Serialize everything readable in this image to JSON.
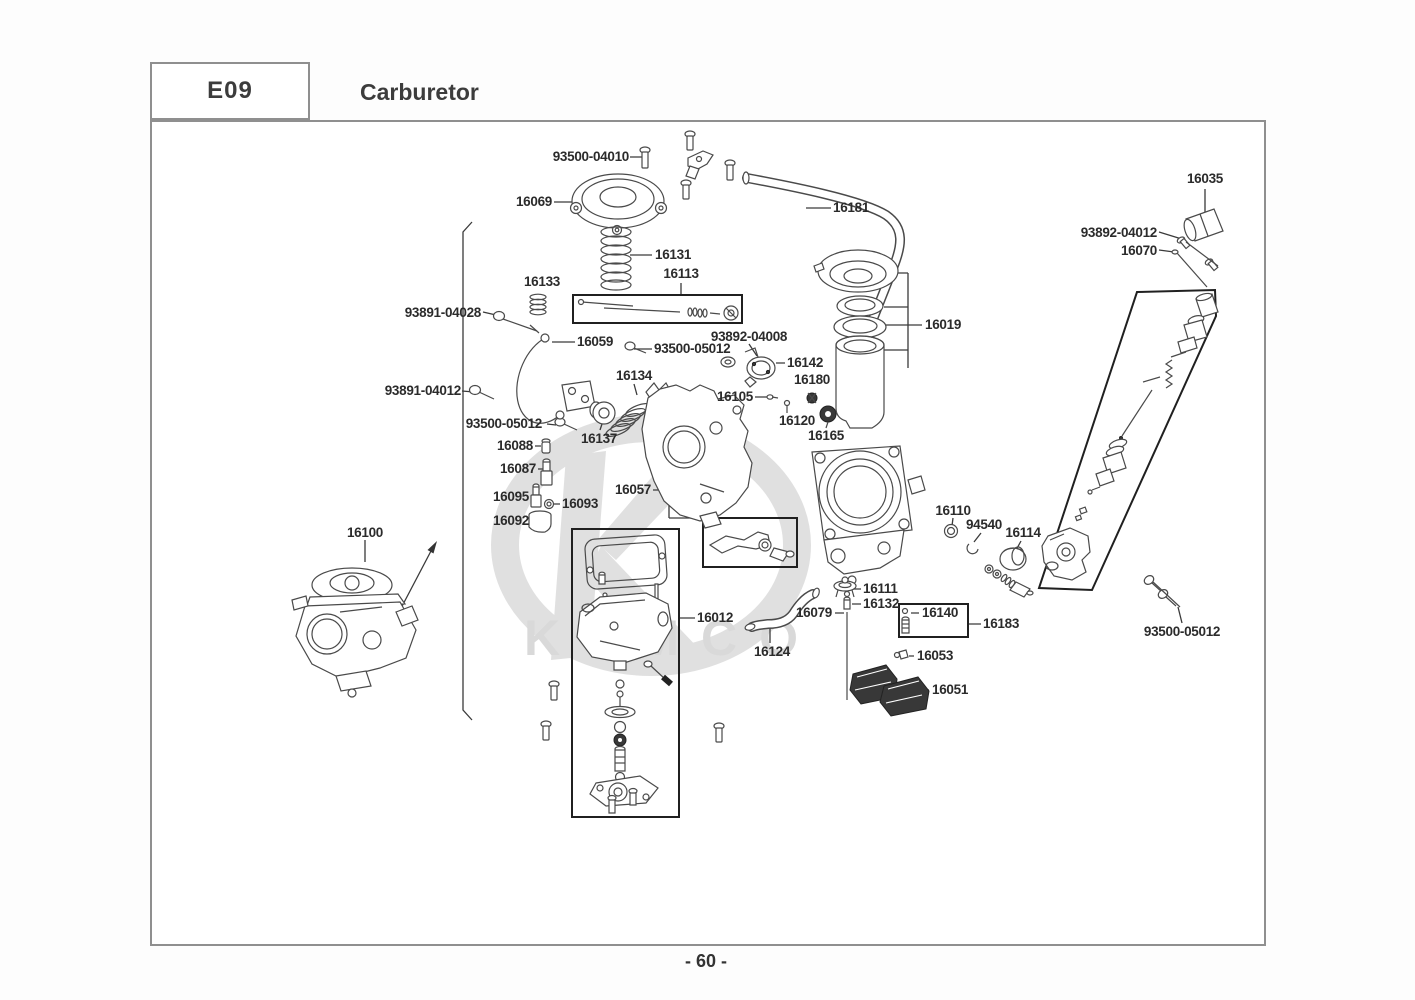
{
  "header": {
    "code": "E09",
    "title": "Carburetor"
  },
  "footer": {
    "page_number": "- 60 -"
  },
  "watermark": {
    "brand": "KYMCO"
  },
  "part_labels": [
    {
      "id": "93500-04010",
      "text": "93500-04010"
    },
    {
      "id": "16069",
      "text": "16069"
    },
    {
      "id": "16181",
      "text": "16181"
    },
    {
      "id": "16035",
      "text": "16035"
    },
    {
      "id": "93892-04012",
      "text": "93892-04012"
    },
    {
      "id": "16070",
      "text": "16070"
    },
    {
      "id": "16131",
      "text": "16131"
    },
    {
      "id": "16113",
      "text": "16113"
    },
    {
      "id": "16133",
      "text": "16133"
    },
    {
      "id": "93891-04028",
      "text": "93891-04028"
    },
    {
      "id": "16059",
      "text": "16059"
    },
    {
      "id": "93500-05012-a",
      "text": "93500-05012"
    },
    {
      "id": "93892-04008",
      "text": "93892-04008"
    },
    {
      "id": "16142",
      "text": "16142"
    },
    {
      "id": "16180",
      "text": "16180"
    },
    {
      "id": "93891-04012",
      "text": "93891-04012"
    },
    {
      "id": "93500-05012-b",
      "text": "93500-05012"
    },
    {
      "id": "16137",
      "text": "16137"
    },
    {
      "id": "16134",
      "text": "16134"
    },
    {
      "id": "16105",
      "text": "16105"
    },
    {
      "id": "16120",
      "text": "16120"
    },
    {
      "id": "16165",
      "text": "16165"
    },
    {
      "id": "16019",
      "text": "16019"
    },
    {
      "id": "16088",
      "text": "16088"
    },
    {
      "id": "16087",
      "text": "16087"
    },
    {
      "id": "16095",
      "text": "16095"
    },
    {
      "id": "16093",
      "text": "16093"
    },
    {
      "id": "16092",
      "text": "16092"
    },
    {
      "id": "16057",
      "text": "16057"
    },
    {
      "id": "16100",
      "text": "16100"
    },
    {
      "id": "16110",
      "text": "16110"
    },
    {
      "id": "94540",
      "text": "94540"
    },
    {
      "id": "16114",
      "text": "16114"
    },
    {
      "id": "16012",
      "text": "16012"
    },
    {
      "id": "16079",
      "text": "16079"
    },
    {
      "id": "16124",
      "text": "16124"
    },
    {
      "id": "16111",
      "text": "16111"
    },
    {
      "id": "16132",
      "text": "16132"
    },
    {
      "id": "16140",
      "text": "16140"
    },
    {
      "id": "16183",
      "text": "16183"
    },
    {
      "id": "16053",
      "text": "16053"
    },
    {
      "id": "16051",
      "text": "16051"
    },
    {
      "id": "93500-05012-c",
      "text": "93500-05012"
    }
  ]
}
